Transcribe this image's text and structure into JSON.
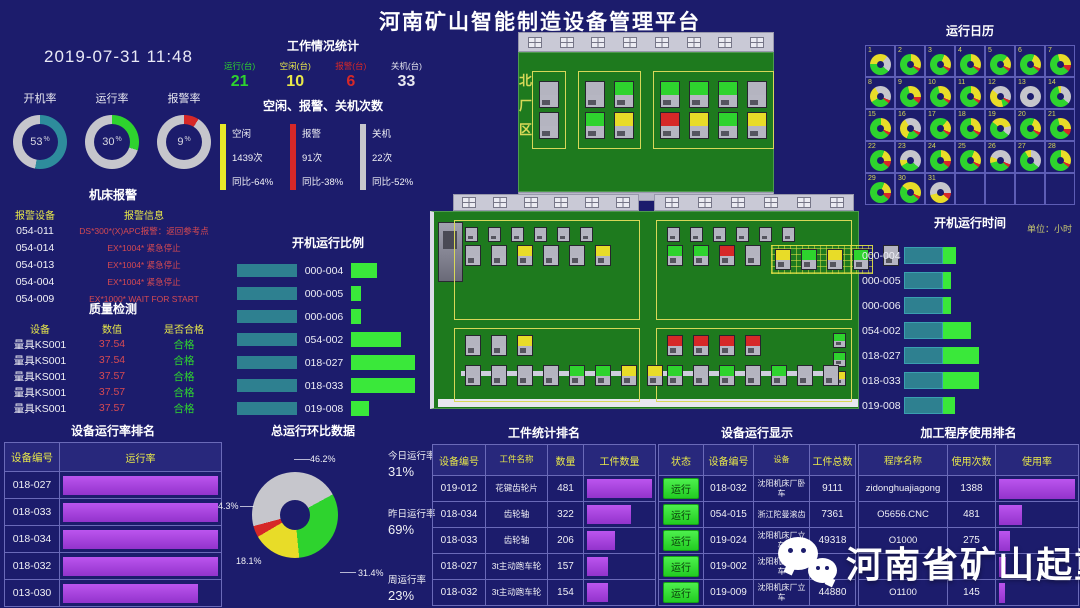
{
  "title": "河南矿山智能制造设备管理平台",
  "colors": {
    "green": "#2ed32e",
    "yellow": "#e8dc28",
    "red": "#d62828",
    "gray": "#c6c6cc",
    "teal": "#2e8c9c",
    "purple": "#a53fd6",
    "bar_green": "#3ae83a",
    "factory_green": "#1e7a1e",
    "accent_text": "#e8e84a",
    "background": "#1c1c6c"
  },
  "left": {
    "datetime": "2019-07-31 11:48",
    "gauges": [
      {
        "label": "开机率",
        "value": 53,
        "unit": "%",
        "color": "#2e8c9c"
      },
      {
        "label": "运行率",
        "value": 30,
        "unit": "%",
        "color": "#2ed32e"
      },
      {
        "label": "报警率",
        "value": 9,
        "unit": "%",
        "color": "#d62828"
      }
    ],
    "alarm": {
      "title": "机床报警",
      "headers": [
        "报警设备",
        "报警信息"
      ],
      "rows": [
        {
          "device": "054-011",
          "message": "DS*300*(X)APC报警：返回参考点"
        },
        {
          "device": "054-014",
          "message": "EX*1004* 紧急停止"
        },
        {
          "device": "054-013",
          "message": "EX*1004* 紧急停止"
        },
        {
          "device": "054-004",
          "message": "EX*1004* 紧急停止"
        },
        {
          "device": "054-009",
          "message": "EX*1000* WAIT FOR START"
        }
      ]
    },
    "quality": {
      "title": "质量检测",
      "headers": [
        "设备",
        "数值",
        "是否合格"
      ],
      "rows": [
        {
          "device": "量具KS001",
          "value": "37.54",
          "result": "合格"
        },
        {
          "device": "量具KS001",
          "value": "37.54",
          "result": "合格"
        },
        {
          "device": "量具KS001",
          "value": "37.57",
          "result": "合格"
        },
        {
          "device": "量具KS001",
          "value": "37.57",
          "result": "合格"
        },
        {
          "device": "量具KS001",
          "value": "37.57",
          "result": "合格"
        }
      ]
    },
    "run_rank": {
      "title": "设备运行率排名",
      "headers": [
        "设备编号",
        "运行率"
      ],
      "rows": [
        {
          "id": "018-027",
          "bar": 100
        },
        {
          "id": "018-033",
          "bar": 100
        },
        {
          "id": "018-034",
          "bar": 100
        },
        {
          "id": "018-032",
          "bar": 100
        },
        {
          "id": "013-030",
          "bar": 87
        }
      ]
    }
  },
  "mid": {
    "work_stats": {
      "title": "工作情况统计",
      "items": [
        {
          "label": "运行(台)",
          "value": "21",
          "color": "#2ed32e"
        },
        {
          "label": "空闲(台)",
          "value": "10",
          "color": "#e8e84a"
        },
        {
          "label": "报警(台)",
          "value": "6",
          "color": "#d62828"
        },
        {
          "label": "关机(台)",
          "value": "33",
          "color": "#e8e8f0"
        }
      ]
    },
    "idle_stats": {
      "title": "空闲、报警、关机次数",
      "items": [
        {
          "label": "空闲",
          "count": "1439次",
          "yoy": "同比-64%",
          "color": "#e8e828"
        },
        {
          "label": "报警",
          "count": "91次",
          "yoy": "同比-38%",
          "color": "#d62828"
        },
        {
          "label": "关机",
          "count": "22次",
          "yoy": "同比-52%",
          "color": "#c6c6cc"
        }
      ]
    },
    "boot_ratio": {
      "title": "开机运行比例",
      "rows": [
        {
          "id": "000-004",
          "green": 26
        },
        {
          "id": "000-005",
          "green": 10
        },
        {
          "id": "000-006",
          "green": 10
        },
        {
          "id": "054-002",
          "green": 50
        },
        {
          "id": "018-027",
          "green": 64
        },
        {
          "id": "018-033",
          "green": 64
        },
        {
          "id": "019-008",
          "green": 18
        }
      ]
    },
    "total_ring": {
      "title": "总运行环比数据",
      "slices": [
        {
          "label": "46.2%",
          "value": 46.2,
          "color": "#c6c6cc"
        },
        {
          "label": "31.4%",
          "value": 31.4,
          "color": "#2ed32e"
        },
        {
          "label": "18.1%",
          "value": 18.1,
          "color": "#e8dc28"
        },
        {
          "label": "4.3%",
          "value": 4.3,
          "color": "#d62828"
        }
      ],
      "side": [
        {
          "label": "今日运行率",
          "value": "31%"
        },
        {
          "label": "昨日运行率",
          "value": "69%"
        },
        {
          "label": "周运行率",
          "value": "23%"
        }
      ]
    }
  },
  "factory": {
    "north_label": "北厂区",
    "north_zones": [
      {
        "rows": [
          "n",
          "n"
        ]
      },
      {
        "rows": [
          "ng",
          "gy"
        ]
      },
      {
        "rows": [
          "gggn",
          "rygy"
        ]
      }
    ],
    "south_quadrants": [
      {
        "rows": [
          {
            "small": true,
            "segs": [
              {
                "m": "nnnnnn"
              }
            ]
          },
          {
            "segs": [
              {
                "m": "nnynny"
              }
            ]
          }
        ]
      },
      {
        "rows": [
          {
            "small": true,
            "segs": [
              {
                "m": "nnnnnn"
              }
            ]
          },
          {
            "segs": [
              {
                "m": "ggrn"
              },
              {
                "grid": true,
                "m": "ygyg"
              },
              {
                "m": "n"
              }
            ]
          }
        ]
      },
      {
        "rows": [
          {
            "segs": [
              {
                "m": "nny"
              }
            ]
          },
          {
            "conveyor": true,
            "segs": [
              {
                "m": "nnnnggyy"
              }
            ]
          }
        ]
      },
      {
        "rows": [
          {
            "segs": [
              {
                "m": "rrrr"
              }
            ]
          },
          {
            "conveyor": true,
            "segs": [
              {
                "m": "gngngnn"
              }
            ]
          },
          {
            "side": true,
            "segs": [
              {
                "m": "ggy"
              }
            ]
          }
        ]
      }
    ]
  },
  "right": {
    "calendar": {
      "title": "运行日历",
      "days": [
        [
          1,
          [
            40,
            35,
            25,
            0
          ]
        ],
        [
          2,
          [
            65,
            30,
            0,
            5
          ]
        ],
        [
          3,
          [
            70,
            25,
            0,
            5
          ]
        ],
        [
          4,
          [
            65,
            30,
            0,
            5
          ]
        ],
        [
          5,
          [
            75,
            20,
            0,
            5
          ]
        ],
        [
          6,
          [
            70,
            25,
            0,
            5
          ]
        ],
        [
          7,
          [
            60,
            30,
            0,
            10
          ]
        ],
        [
          8,
          [
            30,
            25,
            40,
            5
          ]
        ],
        [
          9,
          [
            60,
            30,
            0,
            10
          ]
        ],
        [
          10,
          [
            60,
            35,
            0,
            5
          ]
        ],
        [
          11,
          [
            65,
            30,
            0,
            5
          ]
        ],
        [
          12,
          [
            10,
            40,
            45,
            5
          ]
        ],
        [
          13,
          [
            0,
            0,
            100,
            0
          ]
        ],
        [
          14,
          [
            60,
            5,
            35,
            0
          ]
        ],
        [
          15,
          [
            65,
            30,
            0,
            5
          ]
        ],
        [
          16,
          [
            20,
            35,
            40,
            5
          ]
        ],
        [
          17,
          [
            75,
            20,
            0,
            5
          ]
        ],
        [
          18,
          [
            65,
            30,
            0,
            5
          ]
        ],
        [
          19,
          [
            50,
            35,
            15,
            0
          ]
        ],
        [
          20,
          [
            70,
            25,
            0,
            5
          ]
        ],
        [
          21,
          [
            60,
            30,
            0,
            10
          ]
        ],
        [
          22,
          [
            70,
            20,
            0,
            10
          ]
        ],
        [
          23,
          [
            30,
            10,
            60,
            0
          ]
        ],
        [
          24,
          [
            65,
            25,
            0,
            10
          ]
        ],
        [
          25,
          [
            70,
            25,
            0,
            5
          ]
        ],
        [
          26,
          [
            35,
            10,
            50,
            5
          ]
        ],
        [
          27,
          [
            55,
            10,
            35,
            0
          ]
        ],
        [
          28,
          [
            65,
            30,
            0,
            5
          ]
        ],
        [
          29,
          [
            70,
            20,
            0,
            10
          ]
        ],
        [
          30,
          [
            50,
            45,
            0,
            5
          ]
        ],
        [
          31,
          [
            0,
            35,
            55,
            10
          ]
        ]
      ]
    },
    "boot_time": {
      "title": "开机运行时间",
      "unit": "单位：小时",
      "teal_width": 39,
      "rows": [
        {
          "id": "000-004",
          "green": 13
        },
        {
          "id": "000-005",
          "green": 8
        },
        {
          "id": "000-006",
          "green": 8
        },
        {
          "id": "054-002",
          "green": 28
        },
        {
          "id": "018-027",
          "green": 36
        },
        {
          "id": "018-033",
          "green": 36
        },
        {
          "id": "019-008",
          "green": 12
        }
      ]
    }
  },
  "bottom": {
    "workpiece": {
      "title": "工件统计排名",
      "headers": [
        "设备编号",
        "工件名称",
        "数量",
        "工件数量"
      ],
      "rows": [
        {
          "id": "019-012",
          "name": "花键齿轮片",
          "qty": "481",
          "bar": 100
        },
        {
          "id": "018-034",
          "name": "齿轮轴",
          "qty": "322",
          "bar": 67
        },
        {
          "id": "018-033",
          "name": "齿轮轴",
          "qty": "206",
          "bar": 43
        },
        {
          "id": "018-027",
          "name": "3t主动跑车轮",
          "qty": "157",
          "bar": 33
        },
        {
          "id": "018-032",
          "name": "3t主动跑车轮",
          "qty": "154",
          "bar": 32
        }
      ]
    },
    "device_run": {
      "title": "设备运行显示",
      "headers": [
        "状态",
        "设备编号",
        "设备",
        "工件总数"
      ],
      "status_label": "运行",
      "rows": [
        {
          "id": "018-032",
          "device": "沈阳机床厂卧车",
          "total": "9111"
        },
        {
          "id": "054-015",
          "device": "浙江陀曼滚齿",
          "total": "7361"
        },
        {
          "id": "019-024",
          "device": "沈阳机床厂立车",
          "total": "49318"
        },
        {
          "id": "019-002",
          "device": "沈阳机床厂立车",
          "total": ""
        },
        {
          "id": "019-009",
          "device": "沈阳机床厂立车",
          "total": "44880"
        }
      ]
    },
    "program": {
      "title": "加工程序使用排名",
      "headers": [
        "程序名称",
        "使用次数",
        "使用率"
      ],
      "rows": [
        {
          "name": "zidonghuajiagong",
          "count": "1388",
          "bar": 100
        },
        {
          "name": "O5656.CNC",
          "count": "481",
          "bar": 30
        },
        {
          "name": "O1000",
          "count": "275",
          "bar": 14
        },
        {
          "name": "",
          "count": "",
          "bar": 9
        },
        {
          "name": "O1100",
          "count": "145",
          "bar": 8
        }
      ]
    }
  },
  "watermark": {
    "text": "河南省矿山起重机"
  }
}
